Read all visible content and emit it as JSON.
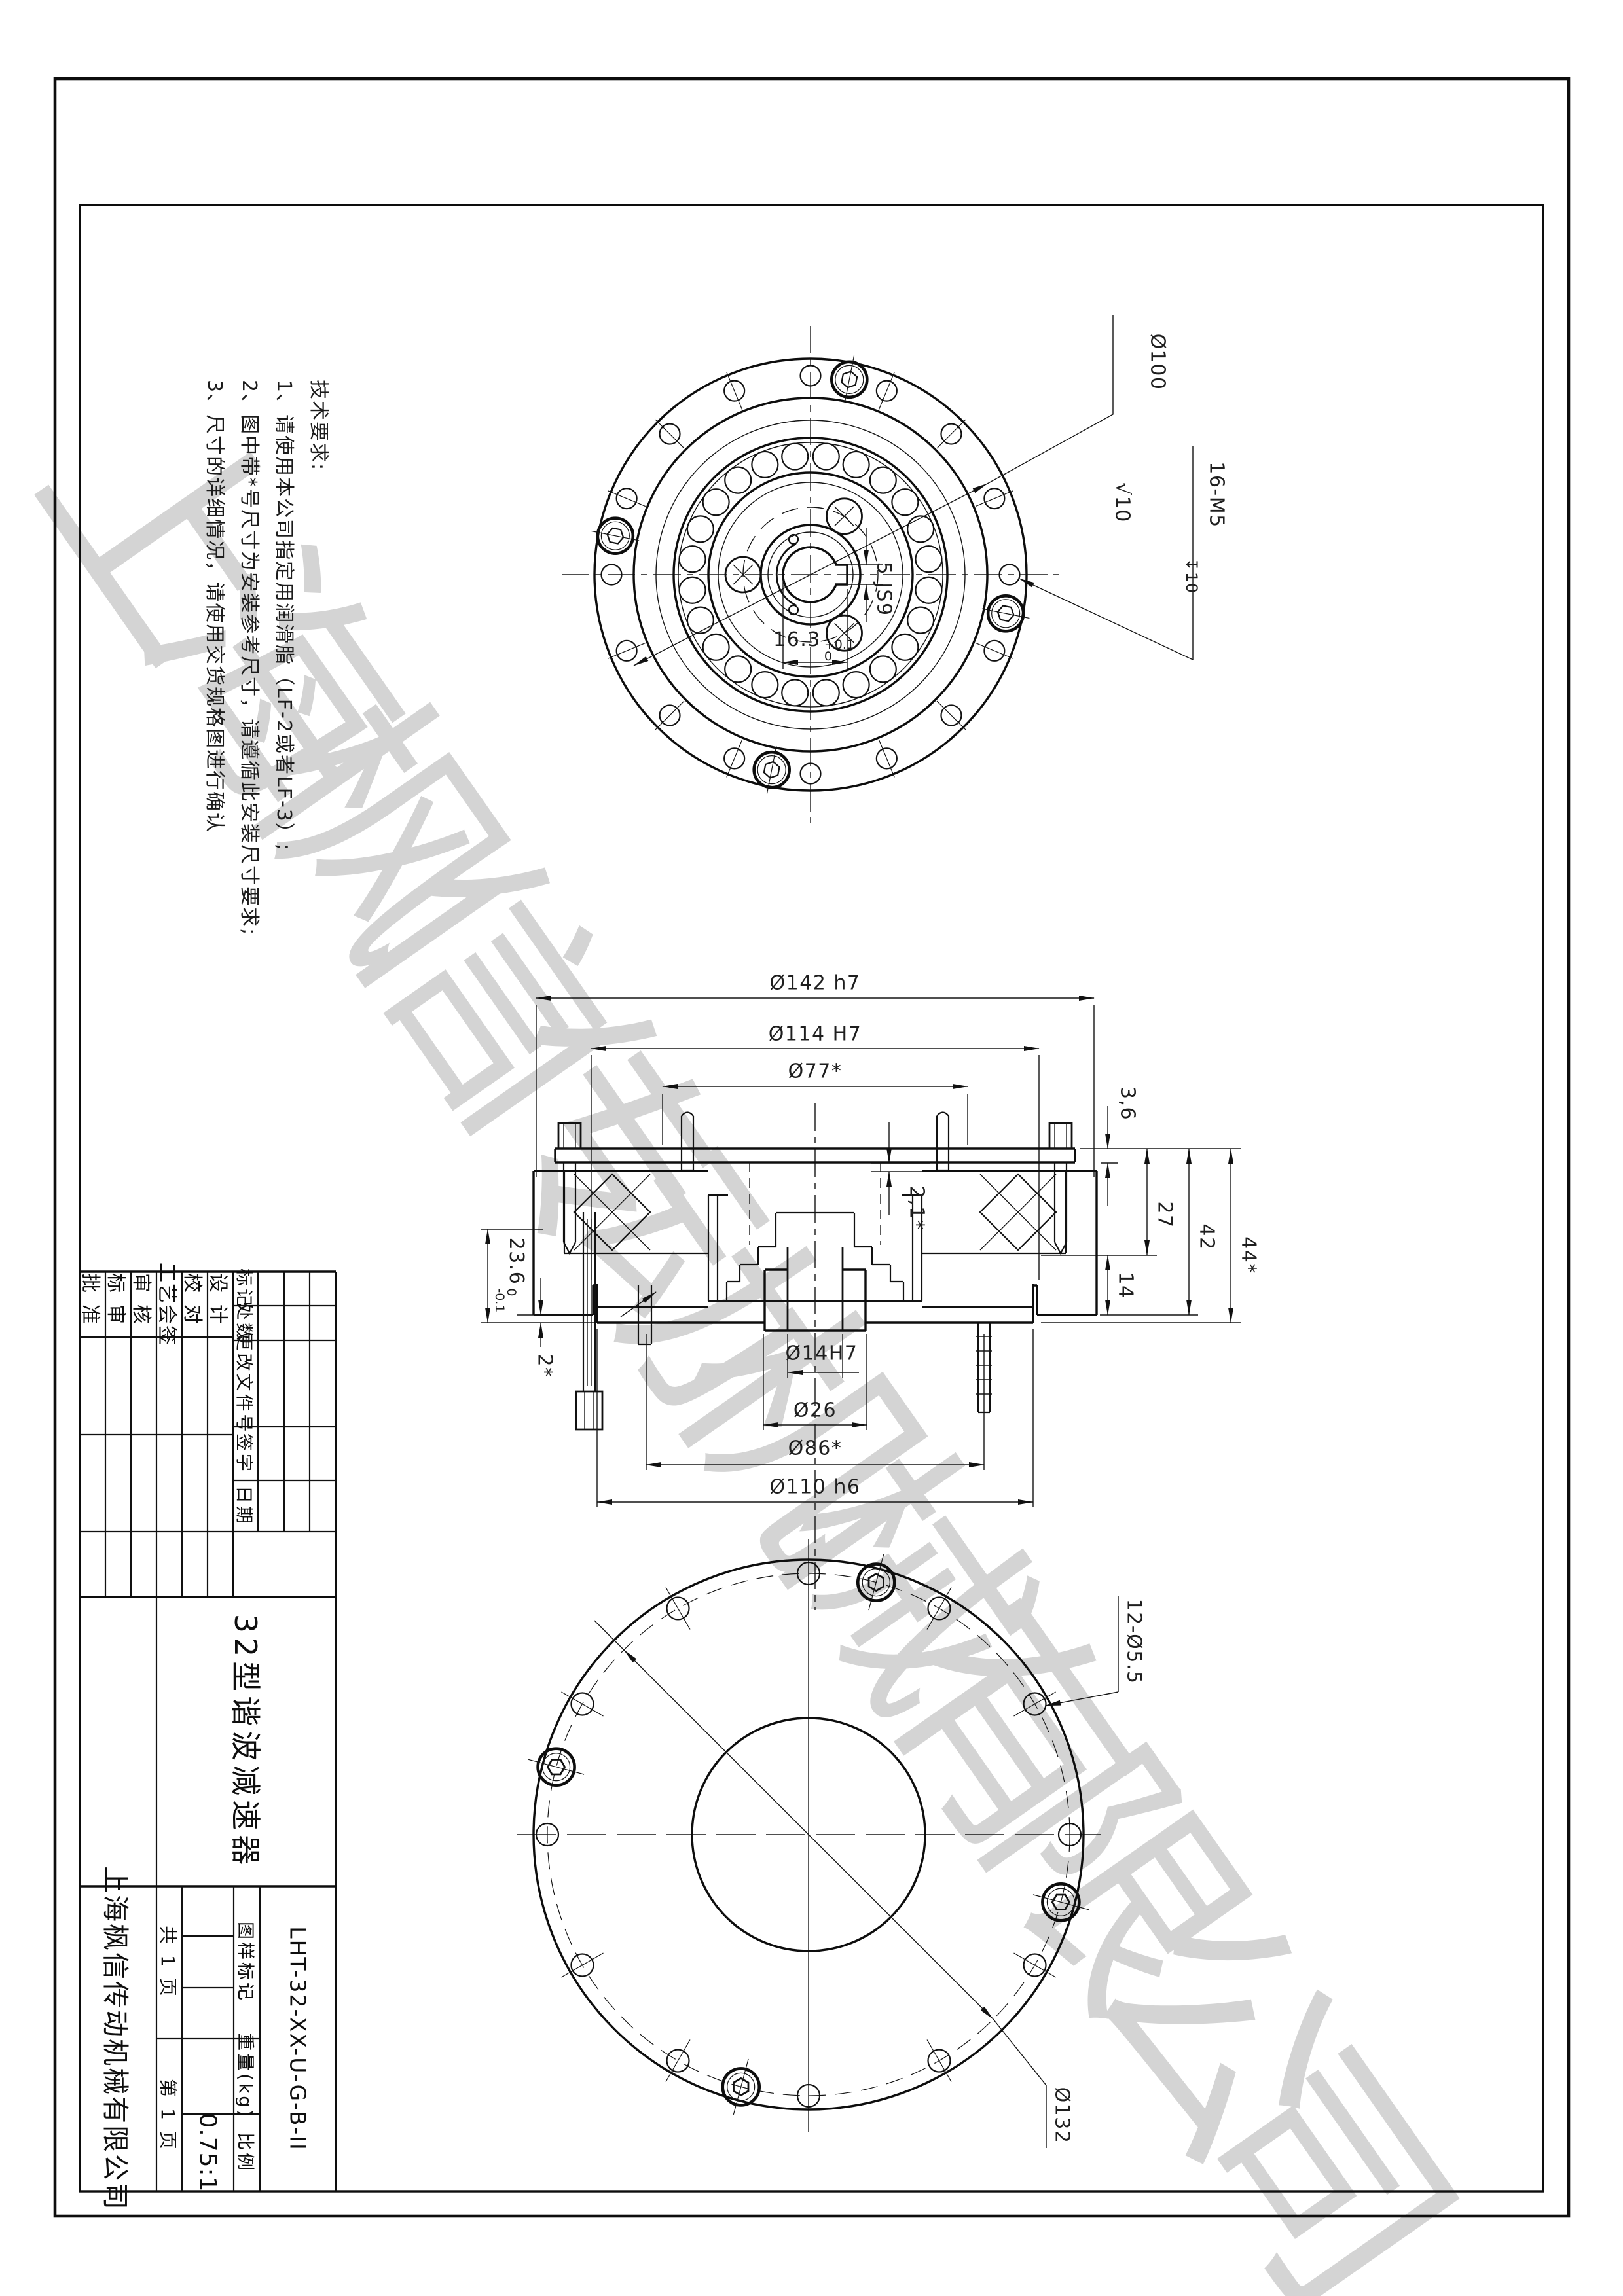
{
  "watermark": "上海枫信传动机械有限公司",
  "tech_requirements": {
    "title": "技术要求:",
    "item1": "1、请使用本公司指定用润滑脂（LF-2或者LF-3）;",
    "item2": "2、图中带*号尺寸为安装参考尺寸，请遵循此安装尺寸要求;",
    "item3": "3、尺寸的详细情况，请使用交货规格图进行确认"
  },
  "top_view": {
    "bolt_circle_dia": "Ø100",
    "thread_spec": "16-M5",
    "thread_depth": "10",
    "surface_finish": "10",
    "key_width": "5 JS9",
    "key_depth": {
      "main": "16.3",
      "upper": "+0.1",
      "lower": "0"
    }
  },
  "section_view": {
    "outer_dia": "Ø142 h7",
    "pilot_dia": "Ø114 H7",
    "ref_dia": "Ø77*",
    "bore_dia": "Ø14H7",
    "hub_dia": "Ø26",
    "bolt_circle": "Ø86*",
    "spigot_dia": "Ø110 h6",
    "flange_thk": "3,6",
    "h27": "27",
    "h42": "42",
    "h44": "44*",
    "h14": "14",
    "gap": "2,1*",
    "depth236": {
      "main": "23.6",
      "upper": "0",
      "lower": "-0.1"
    },
    "proj2": "2*"
  },
  "bottom_view": {
    "holes": "12-Ø5.5",
    "hole_circle_dia": "Ø132"
  },
  "title_block": {
    "sig1": "批准",
    "sig2": "标审",
    "sig3": "审核",
    "sig4": "工艺会签",
    "sig5": "校对",
    "sig6": "设计",
    "rev_mark": "标记",
    "rev_count": "处数",
    "rev_doc": "更改文件号",
    "rev_sign": "签字",
    "rev_date": "日期",
    "part_name": "32型谐波减速器",
    "company": "上海枫信传动机械有限公司",
    "pages_total": "共 1 页",
    "page_no": "第 1 页",
    "stamp_label": "图样标记",
    "weight_label": "重量(kg)",
    "scale_label": "比例",
    "scale_value": "0.75:1",
    "drawing_no": "LHT-32-XX-U-G-B-II"
  }
}
